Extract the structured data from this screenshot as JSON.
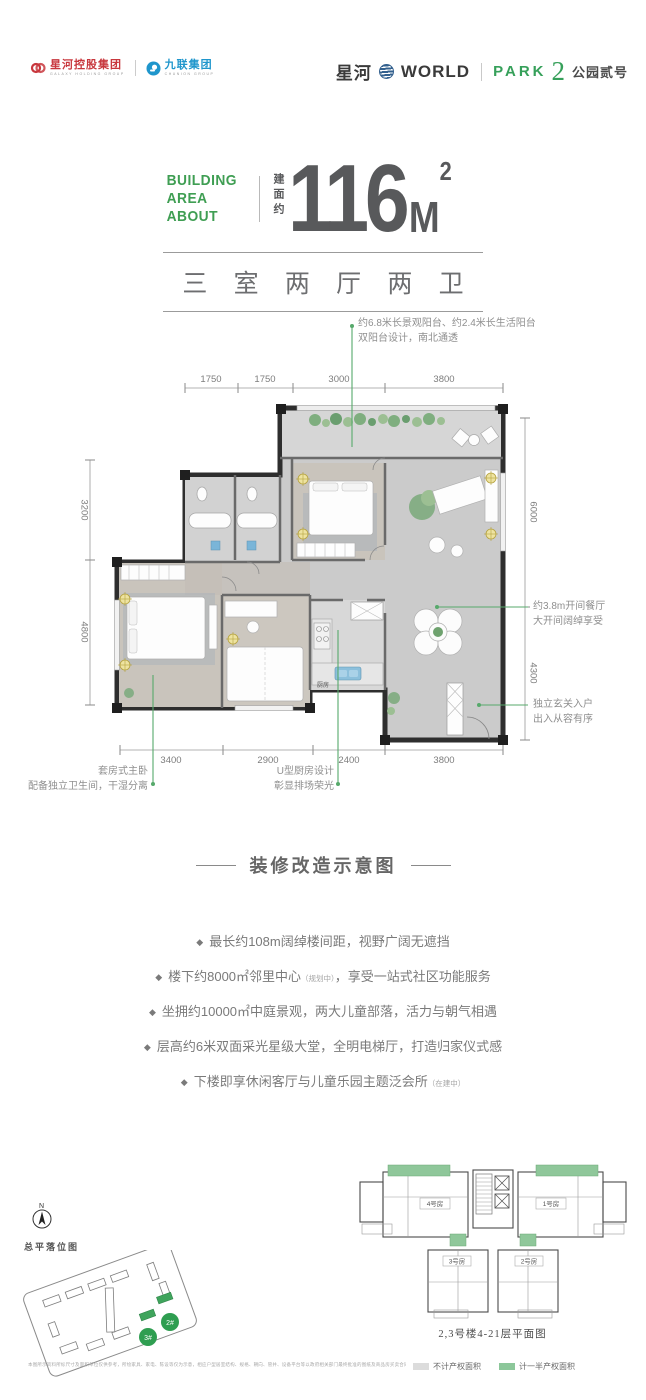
{
  "colors": {
    "accent_green": "#36a05a",
    "annotation_green": "#57a96b",
    "logo_red": "#c8373d",
    "logo_blue": "#1f96cc",
    "headline_gray": "#58595b",
    "legend_gray": "#dcdcdc",
    "legend_green": "#8cc79a"
  },
  "header": {
    "logo1": {
      "name": "星河控股集团",
      "sub": "GALAXY HOLDING GROUP"
    },
    "logo2": {
      "name": "九联集团",
      "sub": "CHUNION GROUP"
    },
    "brand": {
      "cn": "星河",
      "world": "WORLD",
      "park": "PARK",
      "num": "2",
      "suffix": "公园贰号"
    }
  },
  "area": {
    "en1": "BUILDING",
    "en2": "AREA ABOUT",
    "cn": "建面约",
    "value": "116",
    "unit": "M",
    "sup": "2"
  },
  "layout_title": "三 室 两 厅 两 卫",
  "floorplan": {
    "ann_top1": "约6.8米长景观阳台、约2.4米长生活阳台",
    "ann_top2": "双阳台设计，南北通透",
    "ann_right_top1": "约3.8m开间餐厅",
    "ann_right_top2": "大开间阔绰享受",
    "ann_right_bottom1": "独立玄关入户",
    "ann_right_bottom2": "出入从容有序",
    "ann_bottom_left1": "套房式主卧",
    "ann_bottom_left2": "配备独立卫生间，干湿分离",
    "ann_bottom_mid1": "U型厨房设计",
    "ann_bottom_mid2": "彰显排场荣光",
    "kitchen_label": "厨房",
    "dims_top": [
      "1750",
      "1750",
      "3000",
      "3800"
    ],
    "dims_left": [
      "3200",
      "4800"
    ],
    "dims_right": [
      "6000",
      "4300"
    ],
    "dims_bottom": [
      "3400",
      "2900",
      "2400",
      "3800"
    ]
  },
  "renovation": {
    "title": "装修改造示意图",
    "bullets": [
      {
        "pre": "最长约108m阔绰楼间距，视野广阔无遮挡",
        "note": "",
        "post": ""
      },
      {
        "pre": "楼下约8000㎡邻里中心",
        "note": "（规划中）",
        "post": "，享受一站式社区功能服务"
      },
      {
        "pre": "坐拥约10000㎡中庭景观，两大儿童部落，活力与朝气相遇",
        "note": "",
        "post": ""
      },
      {
        "pre": "层高约6米双面采光星级大堂，全明电梯厅，打造归家仪式感",
        "note": "",
        "post": ""
      },
      {
        "pre": "下楼即享休闲客厅与儿童乐园主题泛会所",
        "note": "（在建中）",
        "post": ""
      }
    ]
  },
  "bottom": {
    "compass": "N",
    "siteplan_label": "总平落位图",
    "building2": "2#",
    "building3": "3#",
    "caption": "2,3号楼4-21层平面图",
    "units": {
      "u4": "4号房",
      "u1": "1号房",
      "u3": "3号房",
      "u2": "2号房"
    },
    "legend": [
      {
        "label": "不计产权面积"
      },
      {
        "label": "计一半产权面积"
      }
    ],
    "disclaimer": "本图所示资料所标尺寸及面积单位仅供参考，所绘家具、家电、陈设等仅为示意，相应户型居室结构、规格、朝向、管井、设备平台等以政府相关部门最终批准的图纸及商品房买卖合同约定为准，敬请留意。"
  }
}
